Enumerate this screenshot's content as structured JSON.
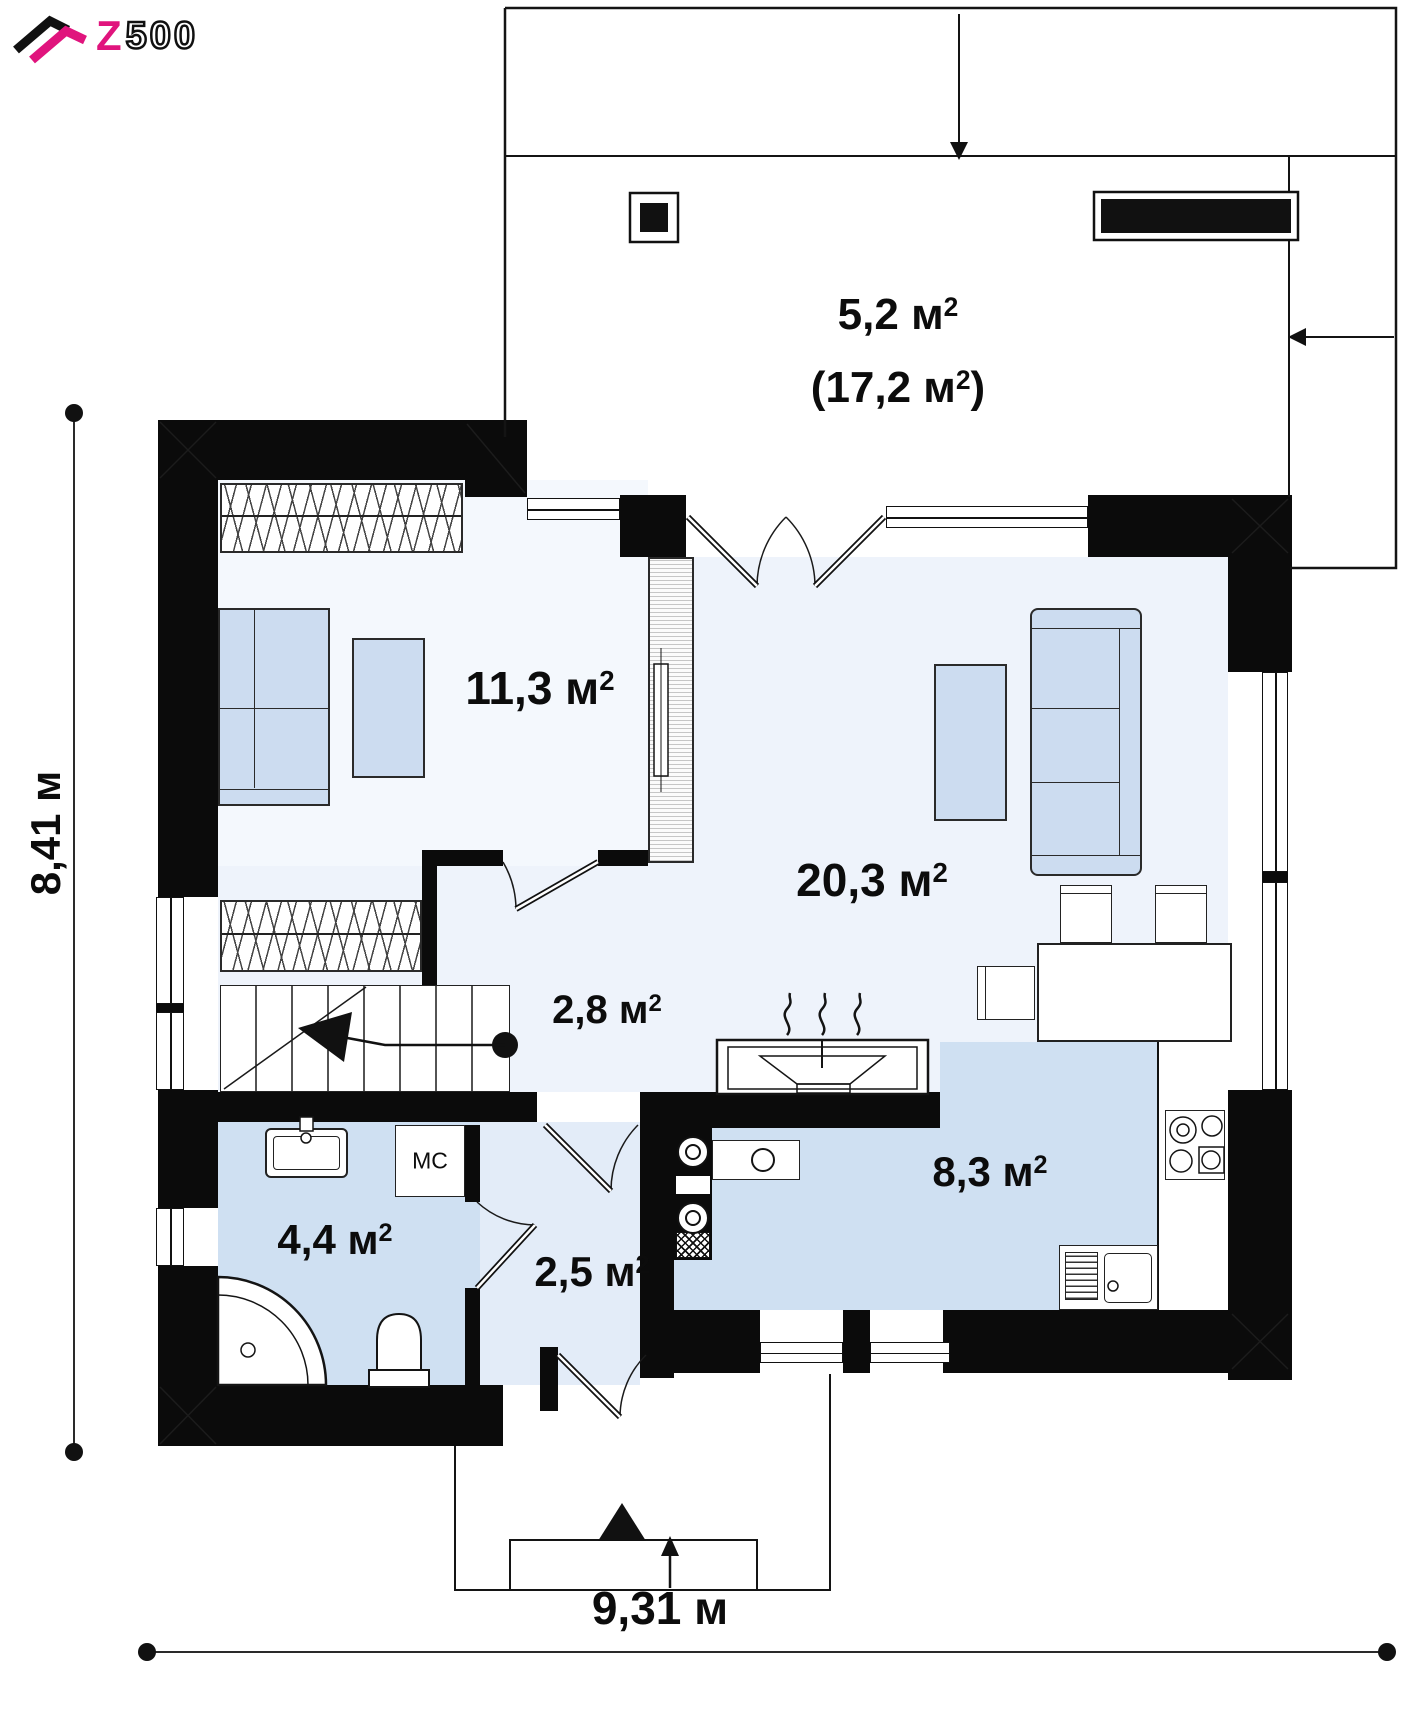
{
  "logo": {
    "letter": "Z",
    "digits": "500"
  },
  "rooms": {
    "terrace_line1": {
      "pre": "5,2 м",
      "sup": "2",
      "post": ""
    },
    "terrace_line2": {
      "pre": "(17,2 м",
      "sup": "2",
      "post": ")"
    },
    "bedroom": {
      "pre": "11,3 м",
      "sup": "2",
      "post": ""
    },
    "living": {
      "pre": "20,3 м",
      "sup": "2",
      "post": ""
    },
    "hall": {
      "pre": "2,8 м",
      "sup": "2",
      "post": ""
    },
    "kitchen": {
      "pre": "8,3 м",
      "sup": "2",
      "post": ""
    },
    "bathroom": {
      "pre": "4,4 м",
      "sup": "2",
      "post": ""
    },
    "vestibule": {
      "pre": "2,5 м",
      "sup": "2",
      "post": ""
    },
    "closet_label": "МС"
  },
  "dimensions": {
    "width": "9,31 м",
    "height": "8,41 м"
  },
  "colors": {
    "wall": "#0b0b0b",
    "logo_pink": "#e0147d",
    "furniture_blue": "#ccdcf0",
    "floor_blue": "#cfe0f2",
    "floor_light": "#eef3fb"
  }
}
